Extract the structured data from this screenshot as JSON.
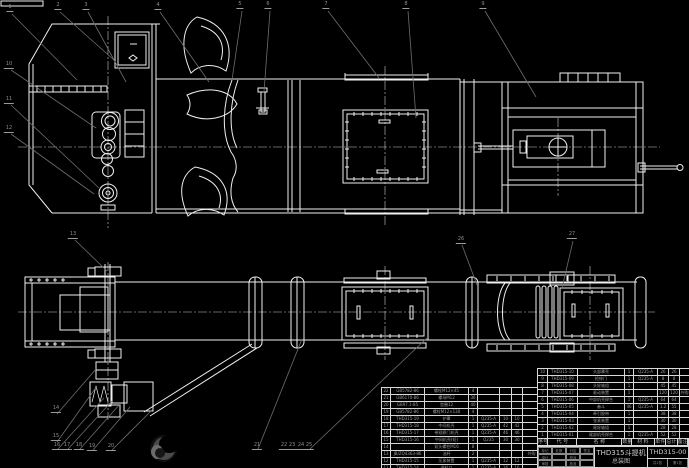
{
  "drawing": {
    "product": "THD315斗提机",
    "doc_type": "总装图",
    "drawing_no": "THD315-00",
    "sheet_note": "共1张",
    "scale_note": "第1张",
    "sign_cells": [
      "标记",
      "处数",
      "分区",
      "签名",
      "设计",
      "",
      "校对",
      "",
      "审核",
      "",
      "批准",
      ""
    ],
    "bom_header": [
      "序号",
      "代 号",
      "名 称",
      "数量",
      "材 料",
      "单件",
      "总计",
      "备注"
    ]
  },
  "bom_right": [
    {
      "seq": "10",
      "code": "THD315-10",
      "name": "头部罩壳",
      "qty": "1",
      "mat": "Q235-A",
      "w1": "26",
      "w2": "26",
      "rem": ""
    },
    {
      "seq": "9",
      "code": "THD315-09",
      "name": "检修门",
      "qty": "1",
      "mat": "Q235-A",
      "w1": "8",
      "w2": "8",
      "rem": ""
    },
    {
      "seq": "8",
      "code": "THD315-08",
      "name": "头轮轴组",
      "qty": "1",
      "mat": "",
      "w1": "45",
      "w2": "45",
      "rem": ""
    },
    {
      "seq": "7",
      "code": "THD315-07",
      "name": "驱动装置",
      "qty": "1",
      "mat": "",
      "w1": "120",
      "w2": "120",
      "rem": "外购"
    },
    {
      "seq": "6",
      "code": "THD315-06",
      "name": "中部机壳焊合",
      "qty": "1",
      "mat": "Q235-A",
      "w1": "64",
      "w2": "64",
      "rem": ""
    },
    {
      "seq": "5",
      "code": "THD315-05",
      "name": "畚斗",
      "qty": "46",
      "mat": "Q235-A",
      "w1": "1.2",
      "w2": "55",
      "rem": ""
    },
    {
      "seq": "4",
      "code": "THD315-04",
      "name": "牵引胶带",
      "qty": "1",
      "mat": "",
      "w1": "38",
      "w2": "38",
      "rem": ""
    },
    {
      "seq": "3",
      "code": "THD315-03",
      "name": "张紧装置",
      "qty": "1",
      "mat": "",
      "w1": "30",
      "w2": "30",
      "rem": ""
    },
    {
      "seq": "2",
      "code": "THD315-02",
      "name": "尾轮轴组",
      "qty": "1",
      "mat": "",
      "w1": "28",
      "w2": "28",
      "rem": ""
    },
    {
      "seq": "1",
      "code": "THD315-01",
      "name": "尾部机壳焊合",
      "qty": "1",
      "mat": "Q235-A",
      "w1": "52",
      "w2": "52",
      "rem": ""
    }
  ],
  "bom_left": [
    {
      "seq": "22",
      "code": "GB5782-86",
      "name": "螺栓M12×45",
      "qty": "4",
      "mat": "",
      "w1": "",
      "w2": "",
      "rem": ""
    },
    {
      "seq": "21",
      "code": "GB6170-86",
      "name": "螺母M12",
      "qty": "36",
      "mat": "",
      "w1": "",
      "w2": "",
      "rem": ""
    },
    {
      "seq": "20",
      "code": "GB97.1-85",
      "name": "垫圈12",
      "qty": "40",
      "mat": "",
      "w1": "",
      "w2": "",
      "rem": ""
    },
    {
      "seq": "19",
      "code": "GB5782-86",
      "name": "螺栓M12×130",
      "qty": "4",
      "mat": "",
      "w1": "",
      "w2": "",
      "rem": ""
    },
    {
      "seq": "18",
      "code": "THD315-19",
      "name": "护罩",
      "qty": "1",
      "mat": "Q235-A",
      "w1": "10",
      "w2": "10",
      "rem": ""
    },
    {
      "seq": "17",
      "code": "THD315-18",
      "name": "中间机壳",
      "qty": "1",
      "mat": "Q235-A",
      "w1": "42",
      "w2": "42",
      "rem": ""
    },
    {
      "seq": "16",
      "code": "THD315-17",
      "name": "带观察门机壳",
      "qty": "1",
      "mat": "Q235-A",
      "w1": "46",
      "w2": "46",
      "rem": ""
    },
    {
      "seq": "15",
      "code": "THD315-16",
      "name": "中间机壳(短)",
      "qty": "1",
      "mat": "Q235",
      "w1": "30",
      "w2": "30",
      "rem": ""
    },
    {
      "seq": "14",
      "code": "",
      "name": "双头螺柱M16",
      "qty": "8",
      "mat": "",
      "w1": "",
      "w2": "",
      "rem": ""
    },
    {
      "seq": "13",
      "code": "JB/ZQ4363-86",
      "name": "油杯",
      "qty": "2",
      "mat": "",
      "w1": "",
      "w2": "",
      "rem": "外购"
    },
    {
      "seq": "12",
      "code": "THD315-15",
      "name": "压紧装置",
      "qty": "1",
      "mat": "Q235-A",
      "w1": "12",
      "w2": "12",
      "rem": ""
    },
    {
      "seq": "11",
      "code": "THD315-14",
      "name": "进料口",
      "qty": "1",
      "mat": "Q235-A",
      "w1": "16",
      "w2": "16",
      "rem": ""
    }
  ],
  "callouts": [
    {
      "n": "1",
      "x": 10,
      "y": 12
    },
    {
      "n": "2",
      "x": 58,
      "y": 10
    },
    {
      "n": "3",
      "x": 86,
      "y": 10
    },
    {
      "n": "4",
      "x": 158,
      "y": 10
    },
    {
      "n": "5",
      "x": 240,
      "y": 9
    },
    {
      "n": "6",
      "x": 268,
      "y": 9
    },
    {
      "n": "7",
      "x": 326,
      "y": 9
    },
    {
      "n": "8",
      "x": 406,
      "y": 9
    },
    {
      "n": "9",
      "x": 483,
      "y": 9
    },
    {
      "n": "10",
      "x": 9,
      "y": 69
    },
    {
      "n": "11",
      "x": 9,
      "y": 104
    },
    {
      "n": "12",
      "x": 9,
      "y": 133
    },
    {
      "n": "13",
      "x": 73,
      "y": 239
    },
    {
      "n": "14",
      "x": 56,
      "y": 413
    },
    {
      "n": "15",
      "x": 56,
      "y": 441
    },
    {
      "n": "16",
      "x": 57,
      "y": 450
    },
    {
      "n": "17",
      "x": 67,
      "y": 450
    },
    {
      "n": "18",
      "x": 79,
      "y": 450
    },
    {
      "n": "19",
      "x": 92,
      "y": 451
    },
    {
      "n": "20",
      "x": 111,
      "y": 451
    },
    {
      "n": "21",
      "x": 257,
      "y": 450
    },
    {
      "n": "22",
      "x": 284,
      "y": 450
    },
    {
      "n": "23",
      "x": 292,
      "y": 450
    },
    {
      "n": "24",
      "x": 301,
      "y": 450
    },
    {
      "n": "25",
      "x": 309,
      "y": 450
    },
    {
      "n": "26",
      "x": 461,
      "y": 244
    },
    {
      "n": "27",
      "x": 572,
      "y": 239
    }
  ]
}
